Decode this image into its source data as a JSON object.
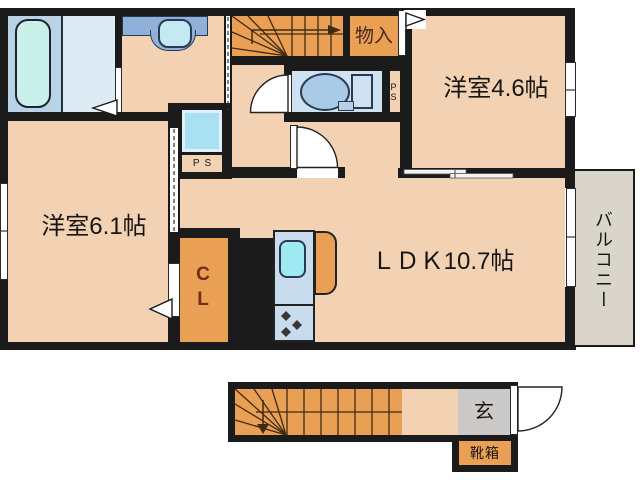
{
  "title": "apartment floor plan",
  "labels": {
    "room_61": "洋室6.1帖",
    "room_46": "洋室4.6帖",
    "ldk": "ＬＤＫ10.7帖",
    "storage": "物入",
    "closet": "CL",
    "balcony": "バルコニー",
    "ps_toilet": "PS",
    "ps_washroom": "PS",
    "entrance": "玄",
    "shoe_box": "靴箱"
  },
  "colors": {
    "wall": "#1b1b1b",
    "floor": "#f2d2b2",
    "fixture_orange": "#e9a055",
    "bath_blue": "#b9d3e6",
    "bath_blue_light": "#dcebf4",
    "water_blue": "#cfe2f2",
    "shaft_blue": "#a9e0f2",
    "kitchen_blue": "#c8dcee",
    "sink_cyan": "#9fe9f2",
    "tub_cyan": "#c9f0e9",
    "vanity_blue": "#8fb0d8",
    "balcony_gray": "#d9d5cb",
    "entrance_gray": "#cbcac8",
    "closet_text": "#6f2c17",
    "stair_line": "#3f2a12"
  },
  "fixtures": {
    "bathtub": "bathtub-icon",
    "washbasin": "washbasin-icon",
    "toilet": "toilet-icon",
    "kitchen_sink": "kitchen-sink-icon",
    "stove_burners": "stove-burner-icon",
    "refrigerator": "refrigerator-icon",
    "stairs_up": "staircase-up-icon",
    "stairs_down": "staircase-down-icon"
  }
}
